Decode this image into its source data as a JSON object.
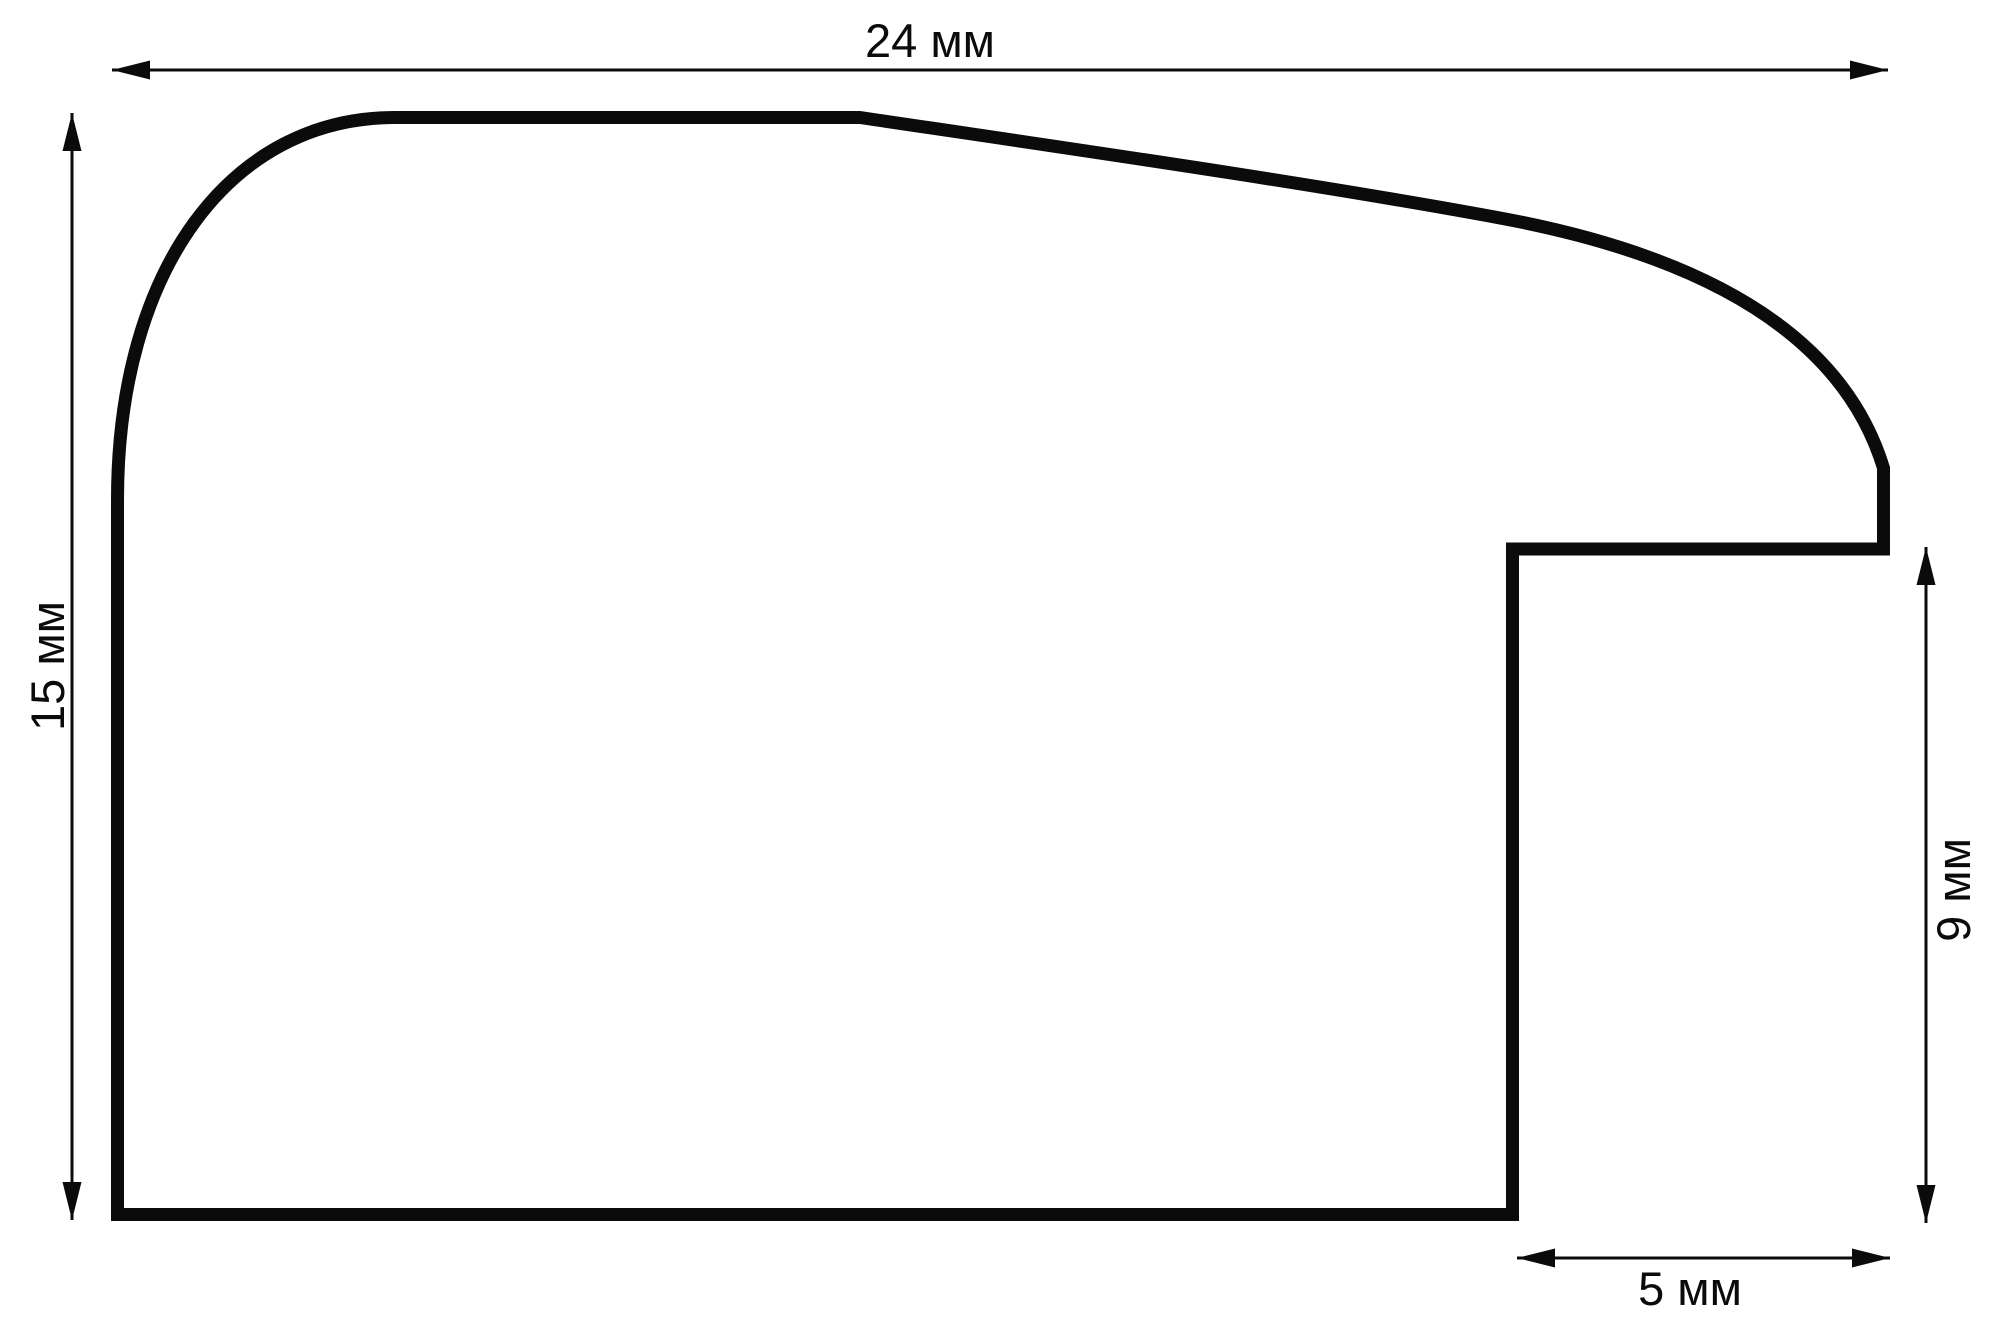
{
  "drawing": {
    "kind": "moulding profile cross-section",
    "unit": "мм",
    "colors": {
      "line": "#0b0b0b",
      "background": "#ffffff"
    },
    "dimensions": {
      "overall_width": {
        "label": "24 мм",
        "value": 24
      },
      "overall_height": {
        "label": "15 мм",
        "value": 15
      },
      "rabbet_depth": {
        "label": "9 мм",
        "value": 9
      },
      "rabbet_width": {
        "label": "5 мм",
        "value": 5
      }
    }
  }
}
